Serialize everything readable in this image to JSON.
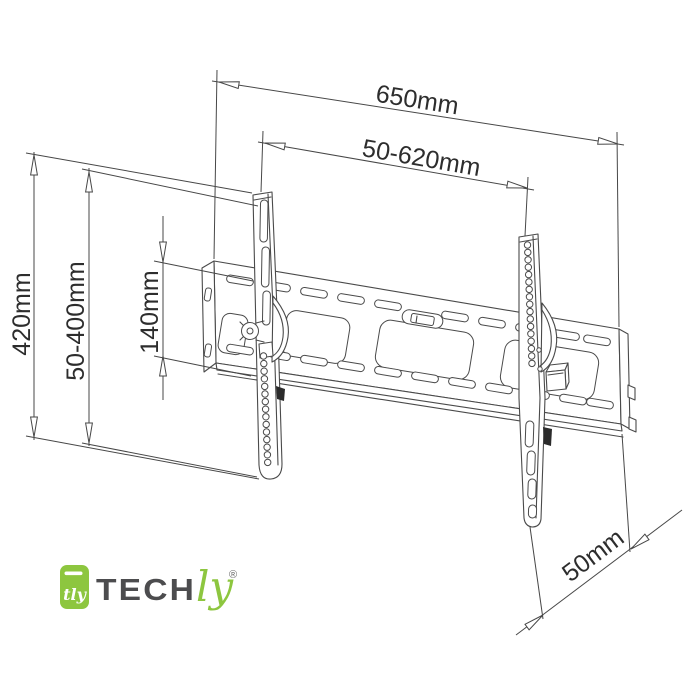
{
  "dimensions": {
    "plate_width": "650mm",
    "bracket_spacing_range": "50-620mm",
    "bracket_height": "420mm",
    "vertical_hole_range": "50-400mm",
    "hole_pitch": "140mm",
    "wall_offset": "50mm"
  },
  "logo": {
    "brand_prefix": "TECH",
    "brand_suffix": "ly",
    "registered_mark": "®",
    "icon_monogram": "tly",
    "brand_green": "#8dc63f",
    "brand_dark": "#4c4c4e"
  },
  "colors": {
    "line": "#4a4a4a",
    "dimension_text": "#2d2d2d",
    "background": "#ffffff"
  }
}
